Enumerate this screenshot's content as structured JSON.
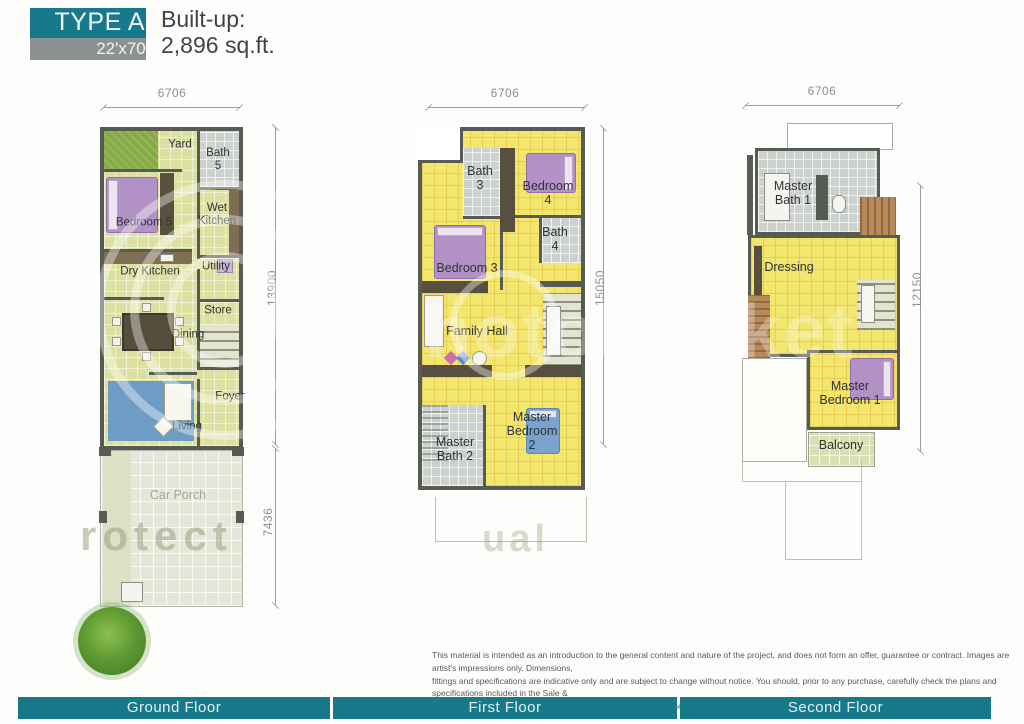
{
  "header": {
    "type_label": "TYPE A",
    "size_label": "22'x70'",
    "builtup_label": "Built-up:",
    "builtup_value": "2,896 sq.ft."
  },
  "ground": {
    "dims": {
      "top": "6706",
      "right": "13900",
      "porch": "7436"
    },
    "rooms": {
      "yard": "Yard",
      "bath5": "Bath\n5",
      "bedroom5": "Bedroom 5",
      "wet_kitchen": "Wet\nKitchen",
      "dry_kitchen": "Dry Kitchen",
      "utility": "Utility",
      "store": "Store",
      "dining": "Dining",
      "foyer": "Foyer",
      "living": "Living",
      "car_porch": "Car Porch"
    }
  },
  "first": {
    "dims": {
      "top": "6706",
      "right": "15050"
    },
    "rooms": {
      "bath3": "Bath\n3",
      "bedroom4": "Bedroom\n4",
      "bedroom3": "Bedroom 3",
      "bath4": "Bath\n4",
      "family_hall": "Family Hall",
      "master_bath2": "Master\nBath 2",
      "master_bedroom2": "Master\nBedroom 2"
    }
  },
  "second": {
    "dims": {
      "top": "6706",
      "right": "12150"
    },
    "rooms": {
      "master_bath1": "Master\nBath 1",
      "dressing": "Dressing",
      "master_bedroom1": "Master\nBedroom 1",
      "balcony": "Balcony"
    }
  },
  "footer_bars": [
    {
      "label": "Ground Floor"
    },
    {
      "label": "First Floor"
    },
    {
      "label": "Second Floor"
    }
  ],
  "disclaimer": "This material is intended as an introduction to the general content and nature of the project, and does not form an offer, guarantee or contract. Images are artist's impressions only. Dimensions,\nfittings and specifications are indicative only and are subject to change without notice. You should, prior to any purchase, carefully check the plans and specifications included in the Sale &\nPurchase Agreement (SPA), and review the terms of the SPA generally.",
  "watermark": {
    "brand_fragment": "hotobucket",
    "protect_fragment": "rotect",
    "small_fragment": "ual"
  },
  "colors": {
    "teal": "#17798a",
    "header_gray": "#8e9192",
    "wall": "#565c54",
    "floor_olive": "#dce0a2",
    "floor_yellow": "#f2e66e",
    "bath_gray": "#cdd1ce",
    "porch": "#e5e7d8",
    "wood": "#b8895a",
    "bed_purple": "#b291c7",
    "bed_blue": "#7aa2cf"
  }
}
